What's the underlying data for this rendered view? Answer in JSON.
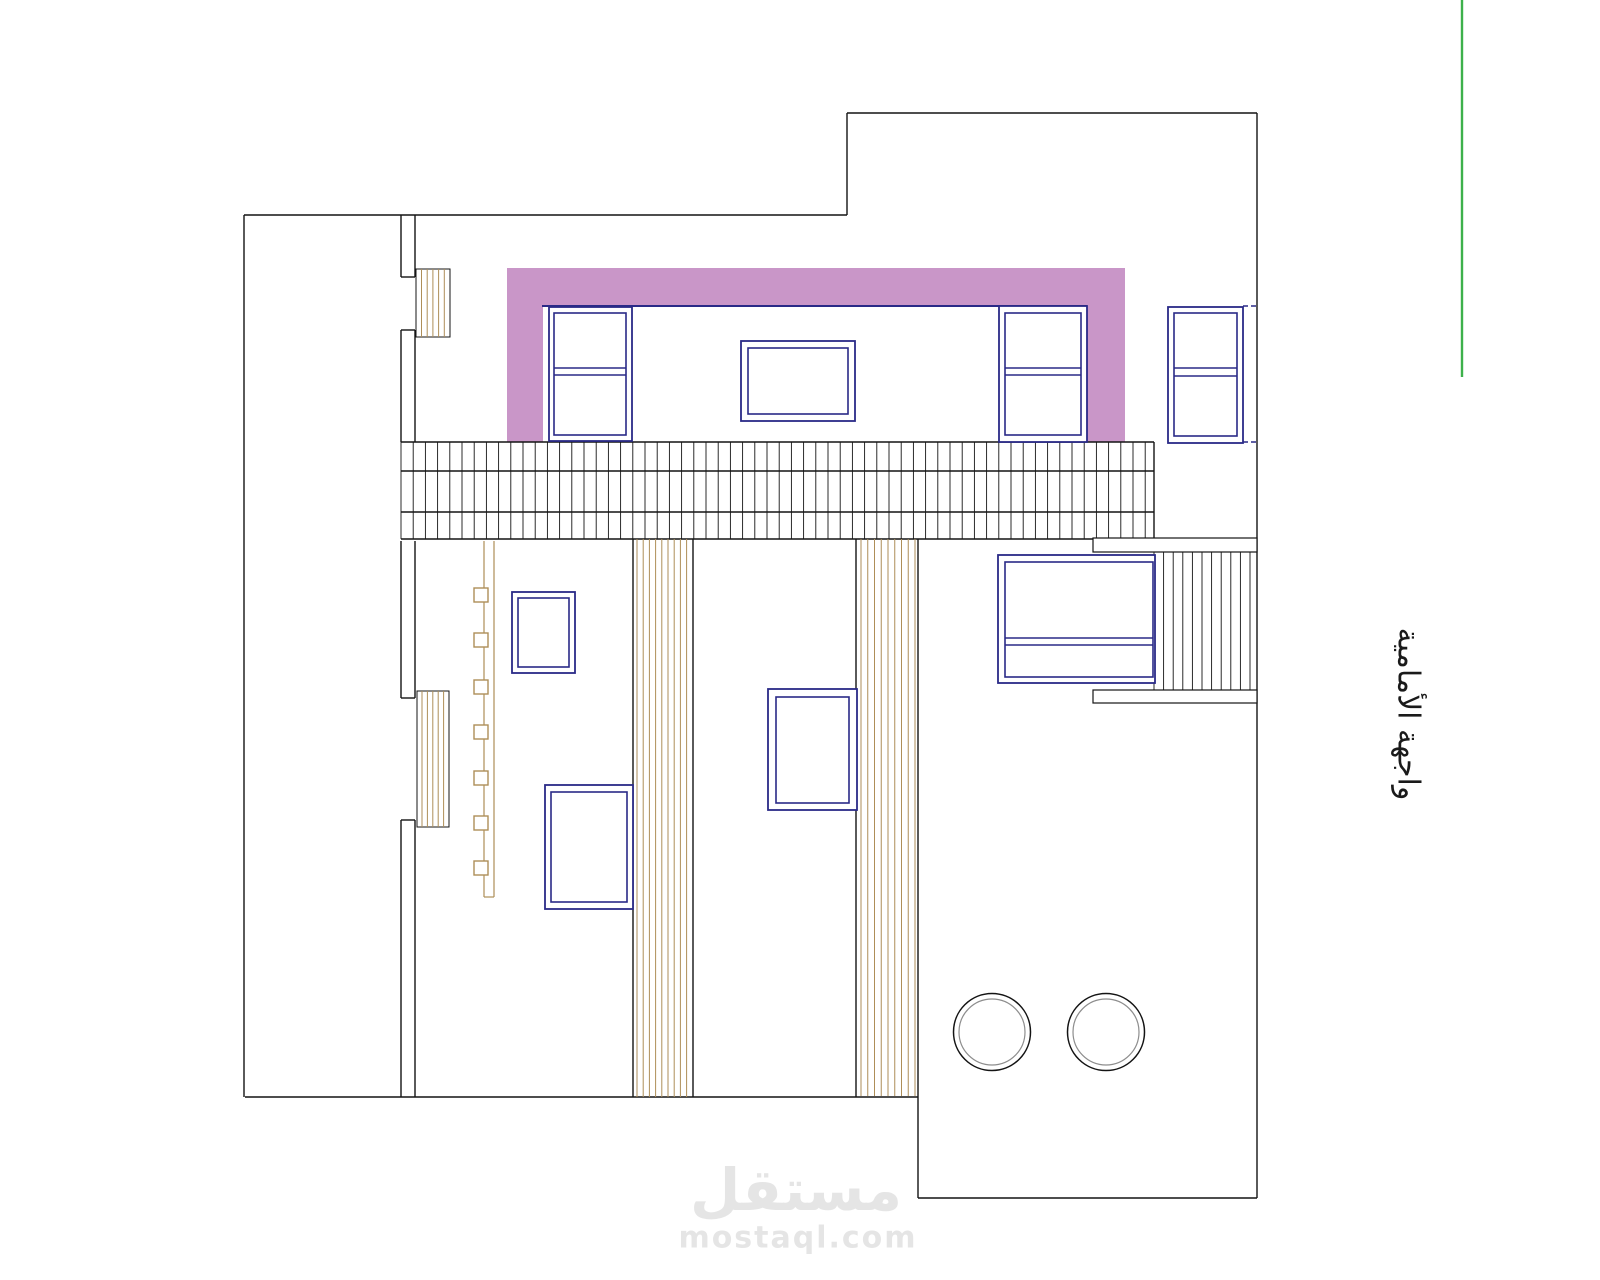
{
  "canvas": {
    "width": 1600,
    "height": 1280,
    "background": "#ffffff"
  },
  "labels": {
    "side_label": "واجهة الأمامية",
    "watermark_logo": "مستقل",
    "watermark_domain": "mostaql.com"
  },
  "colors": {
    "line": "#141414",
    "navy": "#2a2a87",
    "pink": "#c996c8",
    "tan": "#ae8e58",
    "green": "#3db14b",
    "gray": "#8d8d8d",
    "white": "#ffffff",
    "watermark": "#e5e5e5"
  },
  "drawing": {
    "pink_rects": [
      [
        507,
        268,
        618,
        38
      ],
      [
        507,
        306,
        36,
        136
      ],
      [
        1087,
        306,
        38,
        136
      ]
    ],
    "boxes": [
      [
        416,
        269,
        34,
        68
      ],
      [
        417,
        691,
        32,
        136
      ]
    ],
    "black_lines": [
      [
        244,
        215,
        847,
        215
      ],
      [
        847,
        215,
        847,
        113
      ],
      [
        847,
        113,
        1257,
        113
      ],
      [
        1257,
        113,
        1257,
        1198
      ],
      [
        1257,
        1198,
        918,
        1198
      ],
      [
        918,
        1198,
        918,
        539
      ],
      [
        918,
        1097,
        245,
        1097
      ],
      [
        244,
        1097,
        244,
        215
      ],
      [
        401,
        215,
        401,
        277
      ],
      [
        415,
        215,
        415,
        277
      ],
      [
        401,
        277,
        415,
        277
      ],
      [
        401,
        330,
        401,
        442
      ],
      [
        415,
        330,
        415,
        442
      ],
      [
        401,
        330,
        415,
        330
      ],
      [
        401,
        541,
        401,
        698
      ],
      [
        415,
        541,
        415,
        698
      ],
      [
        401,
        698,
        415,
        698
      ],
      [
        401,
        820,
        401,
        1097
      ],
      [
        415,
        820,
        415,
        1097
      ],
      [
        401,
        820,
        415,
        820
      ],
      [
        401,
        442,
        1154,
        442
      ],
      [
        401,
        471,
        1154,
        471
      ],
      [
        401,
        512,
        1154,
        512
      ],
      [
        401,
        539,
        1154,
        539
      ],
      [
        1154,
        442,
        1154,
        539
      ],
      [
        633,
        539,
        633,
        1097
      ],
      [
        693,
        539,
        693,
        1097
      ],
      [
        856,
        539,
        856,
        1097
      ]
    ],
    "hatches": [
      {
        "x1": 401,
        "x2": 1154,
        "y1": 442,
        "y2": 539,
        "step": 12.2,
        "c": "line",
        "w": 0.9
      },
      {
        "x1": 1154,
        "x2": 1250,
        "y1": 552,
        "y2": 690,
        "step": 9.6,
        "c": "line",
        "w": 0.9
      },
      {
        "x1": 637,
        "x2": 687,
        "y1": 539,
        "y2": 1097,
        "step": 6.2,
        "c": "tan",
        "w": 1
      },
      {
        "x1": 861,
        "x2": 915.5,
        "y1": 539,
        "y2": 1096,
        "step": 6.75,
        "c": "tan",
        "w": 1
      },
      {
        "x1": 421.5,
        "x2": 444.5,
        "y1": 269,
        "y2": 337,
        "step": 5.7,
        "c": "tan",
        "w": 1
      },
      {
        "x1": 422,
        "x2": 444,
        "y1": 691,
        "y2": 827,
        "step": 5.4,
        "c": "tan",
        "w": 1
      }
    ],
    "slabs": [
      [
        1093,
        538,
        164,
        14
      ],
      [
        1093,
        690,
        164,
        13
      ]
    ],
    "pipe": {
      "lines": [
        [
          484,
          541,
          484,
          897
        ],
        [
          494,
          541,
          494,
          897
        ],
        [
          484,
          897,
          494,
          897
        ]
      ],
      "square_x": 474,
      "square_size": 14,
      "square_tops": [
        588,
        633,
        680,
        725,
        771,
        816,
        861
      ]
    },
    "windows": [
      {
        "o": [
          549,
          307,
          83,
          134
        ],
        "i": [
          554,
          313,
          72,
          122
        ],
        "div": [
          368,
          375
        ]
      },
      {
        "o": [
          741,
          341,
          114,
          80
        ],
        "i": [
          748,
          348,
          100,
          66
        ],
        "div": null
      },
      {
        "o": [
          999,
          306,
          88,
          136
        ],
        "i": [
          1005,
          313,
          76,
          122
        ],
        "div": [
          368,
          375
        ]
      },
      {
        "o": [
          1168,
          307,
          75,
          136
        ],
        "i": [
          1174,
          313,
          63,
          123
        ],
        "div": [
          368,
          376
        ]
      },
      {
        "o": [
          512,
          592,
          63,
          81
        ],
        "i": [
          518,
          598,
          51,
          69
        ],
        "div": null
      },
      {
        "o": [
          545,
          785,
          88,
          124
        ],
        "i": [
          551,
          792,
          76,
          110
        ],
        "div": null
      },
      {
        "o": [
          768,
          689,
          89,
          121
        ],
        "i": [
          776,
          697,
          73,
          106
        ],
        "div": null
      },
      {
        "o": [
          998,
          555,
          157,
          128
        ],
        "i": [
          1005,
          562,
          148,
          115
        ],
        "div": [
          638,
          645
        ]
      }
    ],
    "navy_lines": [
      [
        542,
        306,
        1087,
        306
      ]
    ],
    "dashed_lines": [
      [
        1243,
        306,
        1257,
        306
      ],
      [
        1243,
        442,
        1257,
        442
      ]
    ],
    "circles": [
      {
        "cx": 992,
        "cy": 1032,
        "r_outer": 38.5,
        "r_inner": 33
      },
      {
        "cx": 1106,
        "cy": 1032,
        "r_outer": 38.5,
        "r_inner": 33
      }
    ],
    "green_line": [
      1462,
      0,
      1462,
      377
    ]
  }
}
